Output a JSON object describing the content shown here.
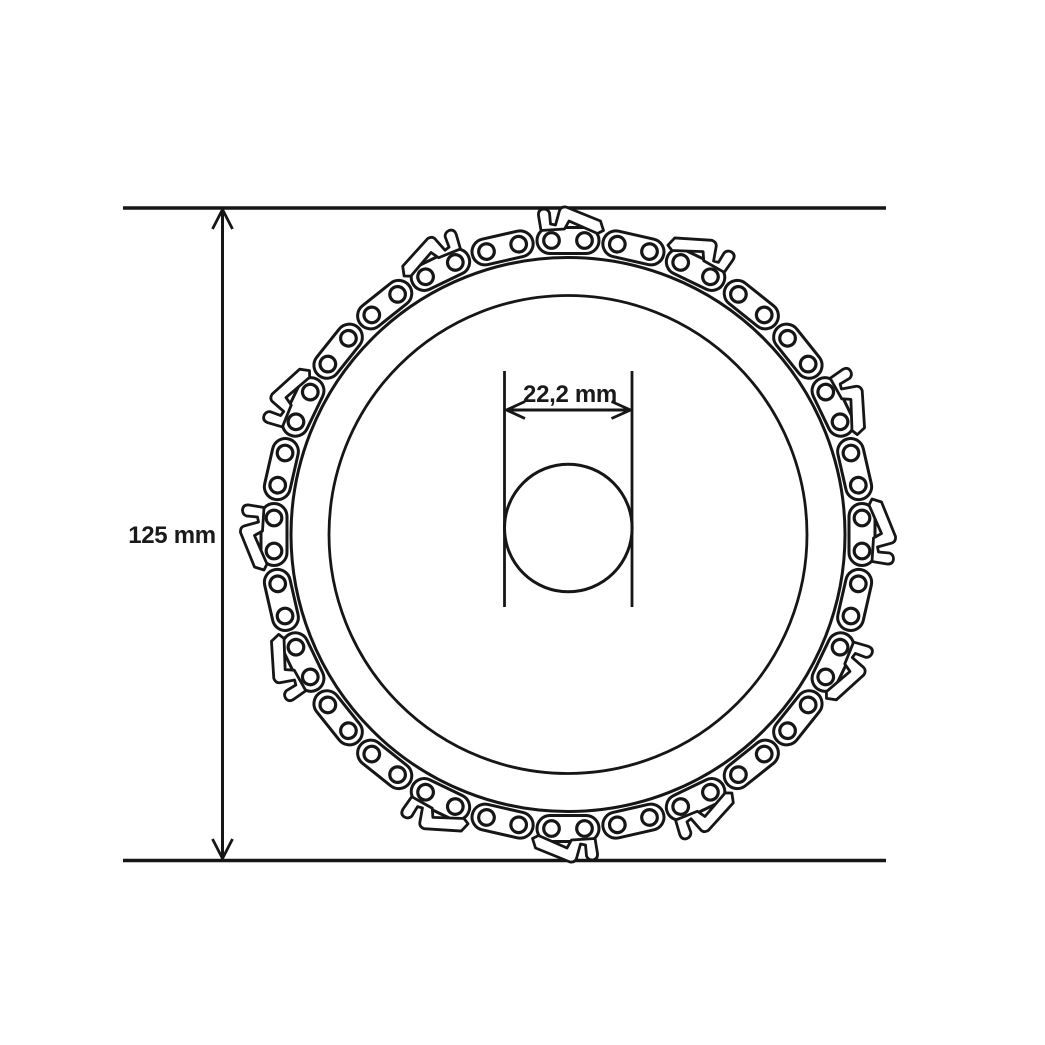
{
  "diagram": {
    "title": "chain-disc-dimension-drawing",
    "outer_dimension_label": "125 mm",
    "bore_dimension_label": "22,2 mm"
  },
  "colors": {
    "line": "#161616",
    "text": "#1a1a1a",
    "background": "#ffffff"
  }
}
